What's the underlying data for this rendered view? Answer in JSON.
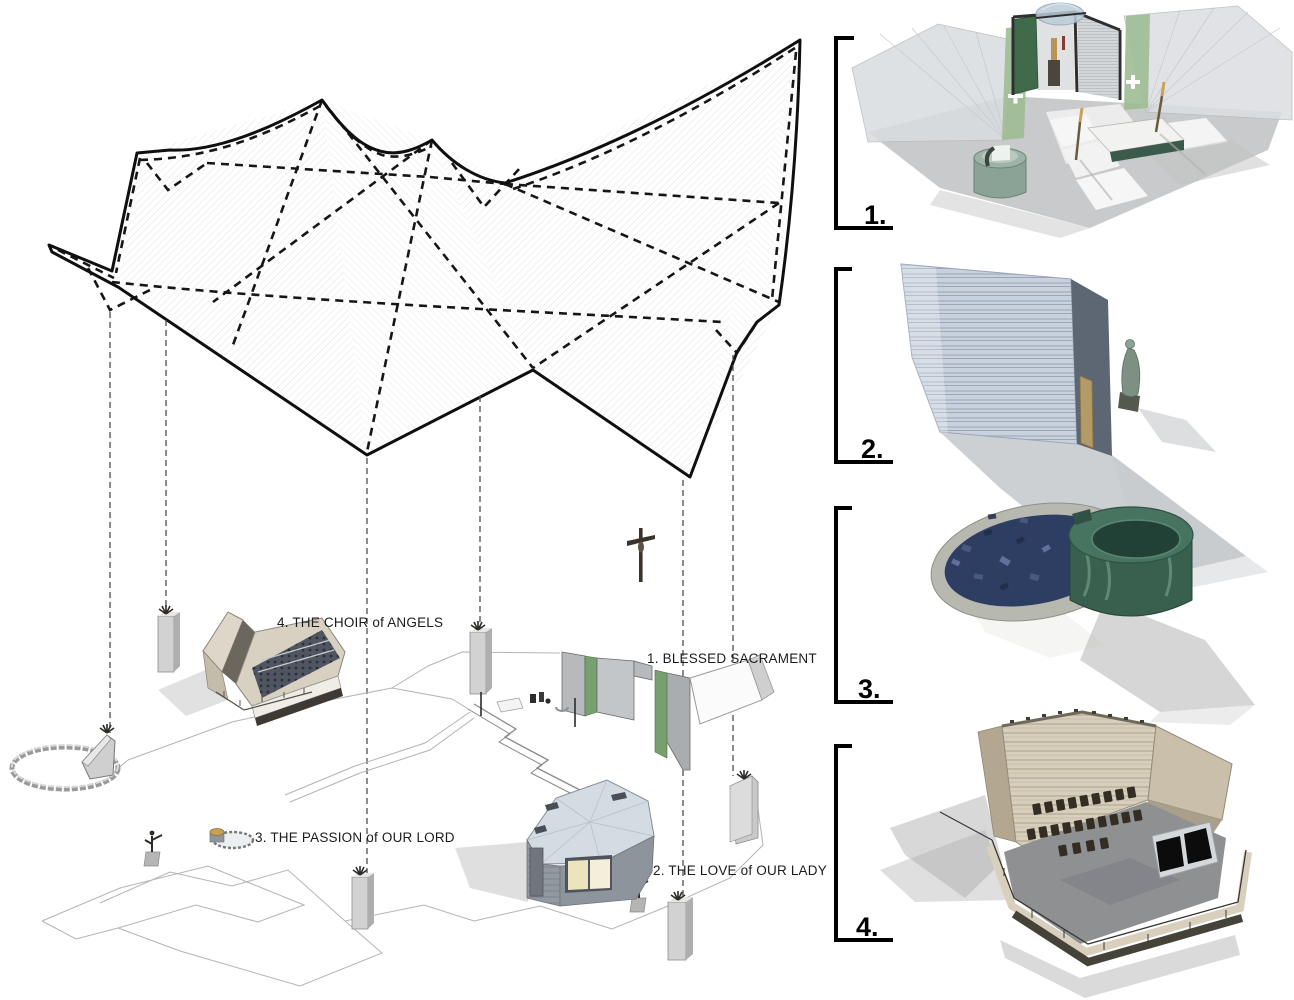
{
  "site_diagram": {
    "labels": {
      "choir": "4. THE CHOIR of ANGELS",
      "blessed_sacrament": "1. BLESSED SACRAMENT",
      "passion": "3. THE PASSION of OUR LORD",
      "our_lady": "2. THE LOVE of OUR LADY"
    }
  },
  "details": {
    "items": [
      {
        "number": "1."
      },
      {
        "number": "2."
      },
      {
        "number": "3."
      },
      {
        "number": "4."
      }
    ]
  },
  "colors": {
    "background": "#ffffff",
    "ink": "#141414",
    "projection_line": "#4d4d4d",
    "site_line": "#b4b4b4",
    "accent_green": "#76a06e",
    "dark_green_panel": "#3f6b4b",
    "water_blue": "#2d3e62",
    "basin_green": "#39604f",
    "stone_blue": "#c8d1dc",
    "sand_tan": "#d7cfbd"
  }
}
